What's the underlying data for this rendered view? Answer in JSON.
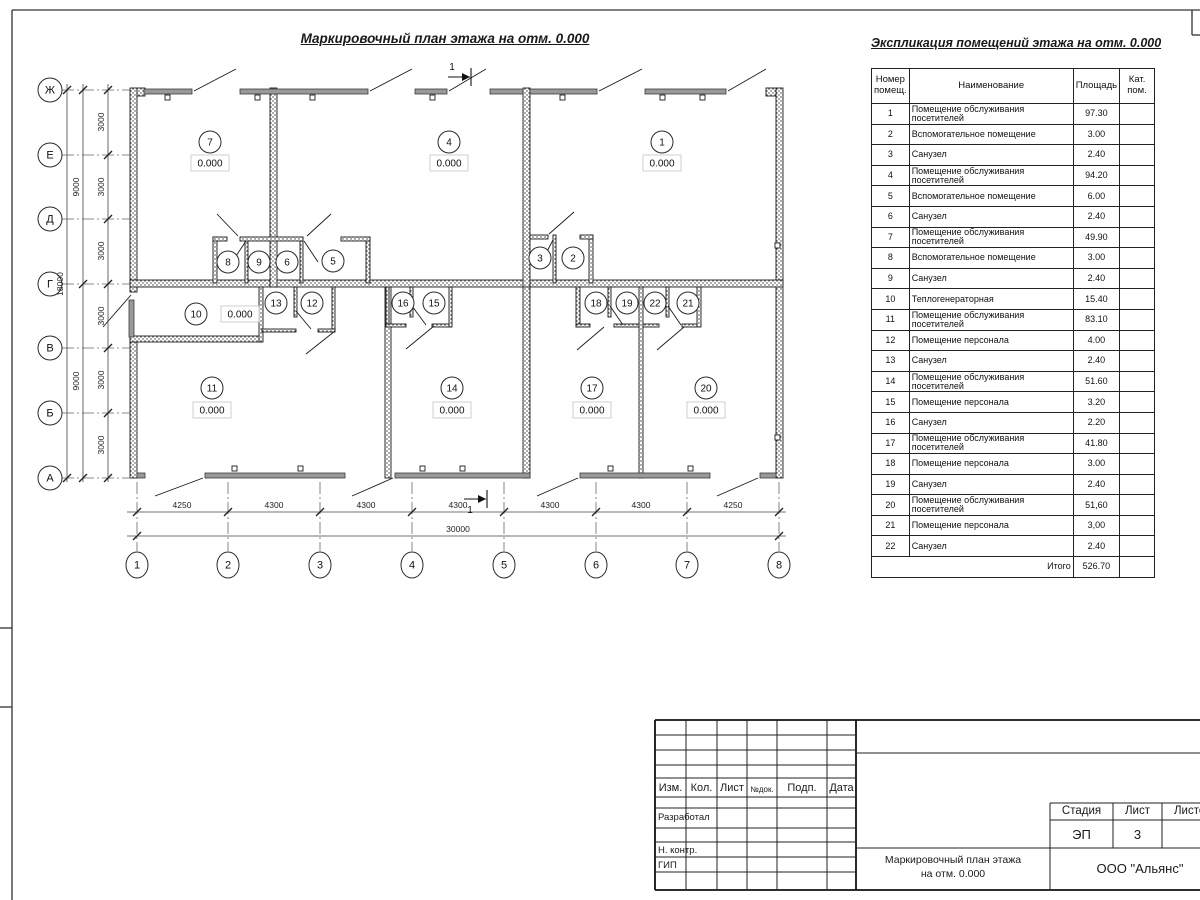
{
  "plan": {
    "title": "Маркировочный план этажа на отм. 0.000",
    "elevation_label": "0.000",
    "section_label": "1",
    "axes_rows": [
      [
        "Ж",
        90
      ],
      [
        "Е",
        155
      ],
      [
        "Д",
        219
      ],
      [
        "Г",
        284
      ],
      [
        "В",
        348
      ],
      [
        "Б",
        413
      ],
      [
        "А",
        478
      ]
    ],
    "axes_cols": [
      [
        "1",
        137
      ],
      [
        "2",
        228
      ],
      [
        "3",
        320
      ],
      [
        "4",
        412
      ],
      [
        "5",
        504
      ],
      [
        "6",
        596
      ],
      [
        "7",
        687
      ],
      [
        "8",
        779
      ]
    ],
    "chains": [
      {
        "dir": "v",
        "pos": 108,
        "from": 84,
        "to": 482,
        "ticks": [
          90,
          155,
          219,
          284,
          348,
          413,
          478
        ],
        "labels": [
          [
            "3000",
            122
          ],
          [
            "3000",
            187
          ],
          [
            "3000",
            251
          ],
          [
            "3000",
            316
          ],
          [
            "3000",
            380
          ],
          [
            "3000",
            445
          ]
        ]
      },
      {
        "dir": "v",
        "pos": 83,
        "from": 84,
        "to": 482,
        "ticks": [
          90,
          284,
          478
        ],
        "labels": [
          [
            "9000",
            187
          ],
          [
            "9000",
            381
          ]
        ]
      },
      {
        "dir": "v",
        "pos": 67,
        "from": 84,
        "to": 482,
        "ticks": [
          90,
          478
        ],
        "labels": [
          [
            "18000",
            284
          ]
        ]
      },
      {
        "dir": "h",
        "pos": 512,
        "from": 127,
        "to": 786,
        "ticks": [
          137,
          228,
          320,
          412,
          504,
          596,
          687,
          779
        ],
        "labels": [
          [
            "4250",
            182
          ],
          [
            "4300",
            274
          ],
          [
            "4300",
            366
          ],
          [
            "4300",
            458
          ],
          [
            "4300",
            550
          ],
          [
            "4300",
            641
          ],
          [
            "4250",
            733
          ]
        ]
      },
      {
        "dir": "h",
        "pos": 536,
        "from": 127,
        "to": 786,
        "ticks": [
          137,
          779
        ],
        "labels": [
          [
            "30000",
            458
          ]
        ]
      }
    ],
    "rooms": [
      {
        "n": "7",
        "x": 210,
        "y": 142,
        "ex": 210,
        "ey": 163
      },
      {
        "n": "4",
        "x": 449,
        "y": 142,
        "ex": 449,
        "ey": 163
      },
      {
        "n": "1",
        "x": 662,
        "y": 142,
        "ex": 662,
        "ey": 163
      },
      {
        "n": "8",
        "x": 228,
        "y": 262
      },
      {
        "n": "9",
        "x": 259,
        "y": 262
      },
      {
        "n": "6",
        "x": 287,
        "y": 262
      },
      {
        "n": "5",
        "x": 333,
        "y": 261
      },
      {
        "n": "3",
        "x": 540,
        "y": 258
      },
      {
        "n": "2",
        "x": 573,
        "y": 258
      },
      {
        "n": "10",
        "x": 196,
        "y": 314,
        "ex": 240,
        "ey": 314
      },
      {
        "n": "13",
        "x": 276,
        "y": 303
      },
      {
        "n": "12",
        "x": 312,
        "y": 303
      },
      {
        "n": "16",
        "x": 403,
        "y": 303
      },
      {
        "n": "15",
        "x": 434,
        "y": 303
      },
      {
        "n": "18",
        "x": 596,
        "y": 303
      },
      {
        "n": "19",
        "x": 627,
        "y": 303
      },
      {
        "n": "22",
        "x": 655,
        "y": 303
      },
      {
        "n": "21",
        "x": 688,
        "y": 303
      },
      {
        "n": "11",
        "x": 212,
        "y": 388,
        "ex": 212,
        "ey": 410
      },
      {
        "n": "14",
        "x": 452,
        "y": 388,
        "ex": 452,
        "ey": 410
      },
      {
        "n": "17",
        "x": 592,
        "y": 388,
        "ex": 592,
        "ey": 410
      },
      {
        "n": "20",
        "x": 706,
        "y": 388,
        "ex": 706,
        "ey": 410
      }
    ],
    "section_marks": [
      {
        "x": 448,
        "y": 77,
        "lx": 452,
        "ly": 70
      },
      {
        "x": 464,
        "y": 499,
        "lx": 470,
        "ly": 513
      }
    ],
    "geometry": {
      "walls": [
        [
          130,
          88,
          7,
          204
        ],
        [
          130,
          337,
          7,
          141
        ],
        [
          776,
          88,
          7,
          390
        ],
        [
          137,
          88,
          8,
          8
        ],
        [
          766,
          88,
          10,
          8
        ],
        [
          130,
          280,
          653,
          7
        ],
        [
          270,
          88,
          7,
          199
        ],
        [
          523,
          88,
          7,
          199
        ],
        [
          385,
          287,
          6,
          191
        ],
        [
          523,
          287,
          7,
          191
        ],
        [
          639,
          287,
          4,
          191
        ],
        [
          130,
          336,
          132,
          6
        ],
        [
          259,
          287,
          4,
          55
        ],
        [
          213,
          237,
          4,
          46
        ],
        [
          245,
          237,
          3,
          46
        ],
        [
          300,
          237,
          3,
          46
        ],
        [
          366,
          237,
          4,
          46
        ],
        [
          213,
          237,
          14,
          4
        ],
        [
          240,
          237,
          63,
          4
        ],
        [
          341,
          237,
          29,
          4
        ],
        [
          553,
          235,
          3,
          48
        ],
        [
          589,
          235,
          4,
          48
        ],
        [
          530,
          235,
          18,
          4
        ],
        [
          580,
          235,
          13,
          4
        ],
        [
          294,
          287,
          3,
          30
        ],
        [
          332,
          287,
          3,
          45
        ],
        [
          262,
          329,
          34,
          3
        ],
        [
          318,
          329,
          17,
          3
        ],
        [
          386,
          287,
          3,
          40
        ],
        [
          410,
          287,
          3,
          30
        ],
        [
          449,
          287,
          3,
          40
        ],
        [
          386,
          324,
          20,
          3
        ],
        [
          432,
          324,
          17,
          3
        ],
        [
          576,
          287,
          4,
          40
        ],
        [
          608,
          287,
          3,
          30
        ],
        [
          576,
          324,
          14,
          3
        ],
        [
          614,
          324,
          25,
          3
        ],
        [
          666,
          287,
          3,
          30
        ],
        [
          697,
          287,
          4,
          40
        ],
        [
          643,
          324,
          16,
          3
        ],
        [
          682,
          324,
          15,
          3
        ]
      ],
      "glazing_top": [
        [
          144,
          192
        ],
        [
          240,
          368
        ],
        [
          415,
          447
        ],
        [
          490,
          523
        ],
        [
          530,
          597
        ],
        [
          645,
          726
        ]
      ],
      "glazing_bottom": [
        [
          137,
          145
        ],
        [
          205,
          345
        ],
        [
          395,
          530
        ],
        [
          580,
          710
        ],
        [
          760,
          776
        ]
      ],
      "door_panel": [
        129,
        300,
        5,
        37
      ],
      "mullions": [
        [
          165,
          95
        ],
        [
          255,
          95
        ],
        [
          310,
          95
        ],
        [
          430,
          95
        ],
        [
          560,
          95
        ],
        [
          660,
          95
        ],
        [
          700,
          95
        ],
        [
          232,
          466
        ],
        [
          298,
          466
        ],
        [
          420,
          466
        ],
        [
          460,
          466
        ],
        [
          608,
          466
        ],
        [
          688,
          466
        ],
        [
          775,
          243
        ],
        [
          775,
          435
        ]
      ],
      "doors": [
        [
          194,
          91,
          236,
          69
        ],
        [
          370,
          91,
          412,
          69
        ],
        [
          449,
          91,
          486,
          69
        ],
        [
          599,
          91,
          642,
          69
        ],
        [
          728,
          91,
          766,
          69
        ],
        [
          203,
          478,
          155,
          496
        ],
        [
          393,
          478,
          352,
          496
        ],
        [
          578,
          478,
          537,
          496
        ],
        [
          758,
          478,
          717,
          496
        ],
        [
          131,
          295,
          103,
          327
        ],
        [
          238,
          236,
          217,
          214
        ],
        [
          307,
          236,
          331,
          214
        ],
        [
          246,
          241,
          232,
          262
        ],
        [
          304,
          241,
          318,
          262
        ],
        [
          549,
          234,
          574,
          212
        ],
        [
          553,
          240,
          542,
          261
        ],
        [
          296,
          311,
          311,
          329
        ],
        [
          335,
          331,
          306,
          354
        ],
        [
          412,
          306,
          426,
          325
        ],
        [
          434,
          326,
          406,
          349
        ],
        [
          610,
          306,
          623,
          325
        ],
        [
          604,
          327,
          577,
          350
        ],
        [
          668,
          306,
          681,
          325
        ],
        [
          684,
          327,
          657,
          350
        ]
      ]
    }
  },
  "schedule": {
    "title": "Экспликация помещений этажа на отм. 0.000",
    "headers": {
      "num": "Номер\nпомещ.",
      "name": "Наименование",
      "area": "Площадь",
      "cat": "Кат.\nпом."
    },
    "rows": [
      [
        "1",
        "Помещение обслуживания посетителей",
        "97.30",
        ""
      ],
      [
        "2",
        "Вспомогательное помещение",
        "3.00",
        ""
      ],
      [
        "3",
        "Санузел",
        "2.40",
        ""
      ],
      [
        "4",
        "Помещение обслуживания посетителей",
        "94.20",
        ""
      ],
      [
        "5",
        "Вспомогательное помещение",
        "6.00",
        ""
      ],
      [
        "6",
        "Санузел",
        "2.40",
        ""
      ],
      [
        "7",
        "Помещение обслуживания посетителей",
        "49.90",
        ""
      ],
      [
        "8",
        "Вспомогательное помещение",
        "3.00",
        ""
      ],
      [
        "9",
        "Санузел",
        "2.40",
        ""
      ],
      [
        "10",
        "Теплогенераторная",
        "15.40",
        ""
      ],
      [
        "11",
        "Помещение обслуживания посетителей",
        "83.10",
        ""
      ],
      [
        "12",
        "Помещение персонала",
        "4.00",
        ""
      ],
      [
        "13",
        "Санузел",
        "2.40",
        ""
      ],
      [
        "14",
        "Помещение обслуживания посетителей",
        "51.60",
        ""
      ],
      [
        "15",
        "Помещение персонала",
        "3.20",
        ""
      ],
      [
        "16",
        "Санузел",
        "2.20",
        ""
      ],
      [
        "17",
        "Помещение обслуживания посетителей",
        "41.80",
        ""
      ],
      [
        "18",
        "Помещение персонала",
        "3.00",
        ""
      ],
      [
        "19",
        "Санузел",
        "2.40",
        ""
      ],
      [
        "20",
        "Помещение обслуживания посетителей",
        "51,60",
        ""
      ],
      [
        "21",
        "Помещение персонала",
        "3,00",
        ""
      ],
      [
        "22",
        "Санузел",
        "2.40",
        ""
      ]
    ],
    "total_label": "Итого",
    "total_value": "526.70"
  },
  "titleblock": {
    "cols_header": [
      "Изм.",
      "Кол.",
      "Лист",
      "№док.",
      "Подп.",
      "Дата"
    ],
    "row_labels": [
      "Разработал",
      "Н. контр.",
      "ГИП"
    ],
    "stage_label": "Стадия",
    "sheet_label": "Лист",
    "sheets_label": "Листов",
    "stage": "ЭП",
    "sheet": "3",
    "doc_title_line1": "Маркировочный план этажа",
    "doc_title_line2": "на отм. 0.000",
    "company": "ООО \"Альянс\""
  }
}
